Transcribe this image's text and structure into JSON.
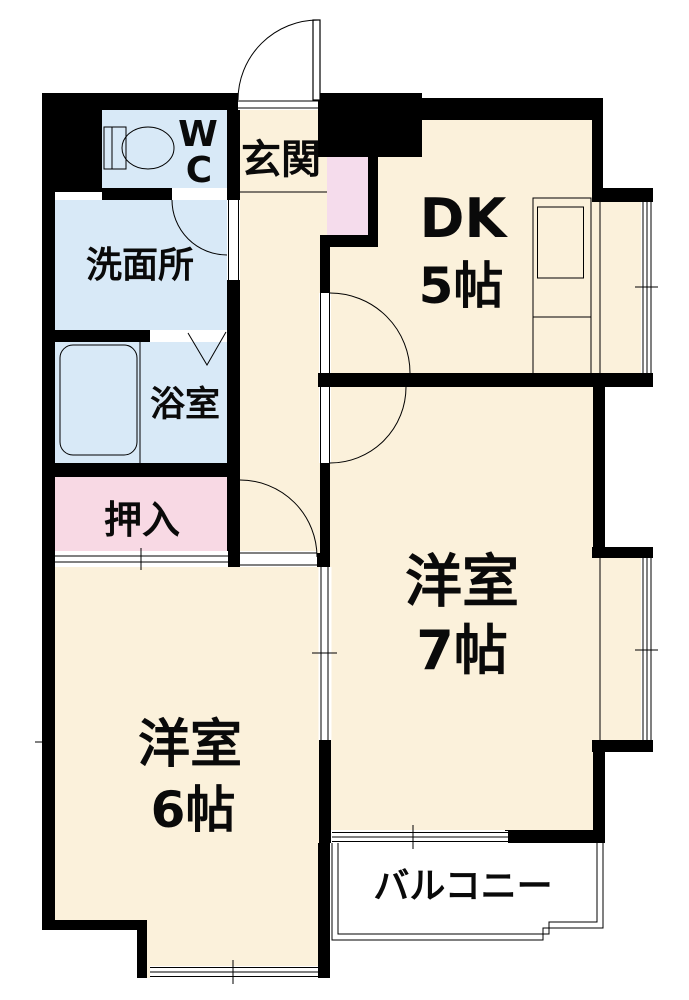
{
  "meta": {
    "title": "Japanese apartment floor plan (2DK)"
  },
  "colors": {
    "wall": "#000000",
    "room_floor": "#FBF1DB",
    "wet_area": "#D8E9F7",
    "closet_pink": "#F8D9E4",
    "entry_cabinet_pink": "#F5DCEC",
    "fixture_blue": "#D8E9F7",
    "outline": "#000000",
    "exterior": "#FFFFFF"
  },
  "rooms": {
    "entrance": {
      "label": "玄関"
    },
    "wc": {
      "line1": "W",
      "line2": "C"
    },
    "dining_kitchen": {
      "name": "DK",
      "size": "5帖"
    },
    "washroom": {
      "label": "洗面所"
    },
    "bathroom": {
      "label": "浴室"
    },
    "closet": {
      "label": "押入"
    },
    "western_room_7": {
      "name": "洋室",
      "size": "7帖"
    },
    "western_room_6": {
      "name": "洋室",
      "size": "6帖"
    },
    "balcony": {
      "label": "バルコニー"
    }
  },
  "fixtures": [
    "toilet-icon",
    "bathtub-icon",
    "kitchen-counter-sink-icon",
    "folding-door-icon",
    "door-swing-arc",
    "sliding-door-symbol",
    "window-symbol"
  ]
}
